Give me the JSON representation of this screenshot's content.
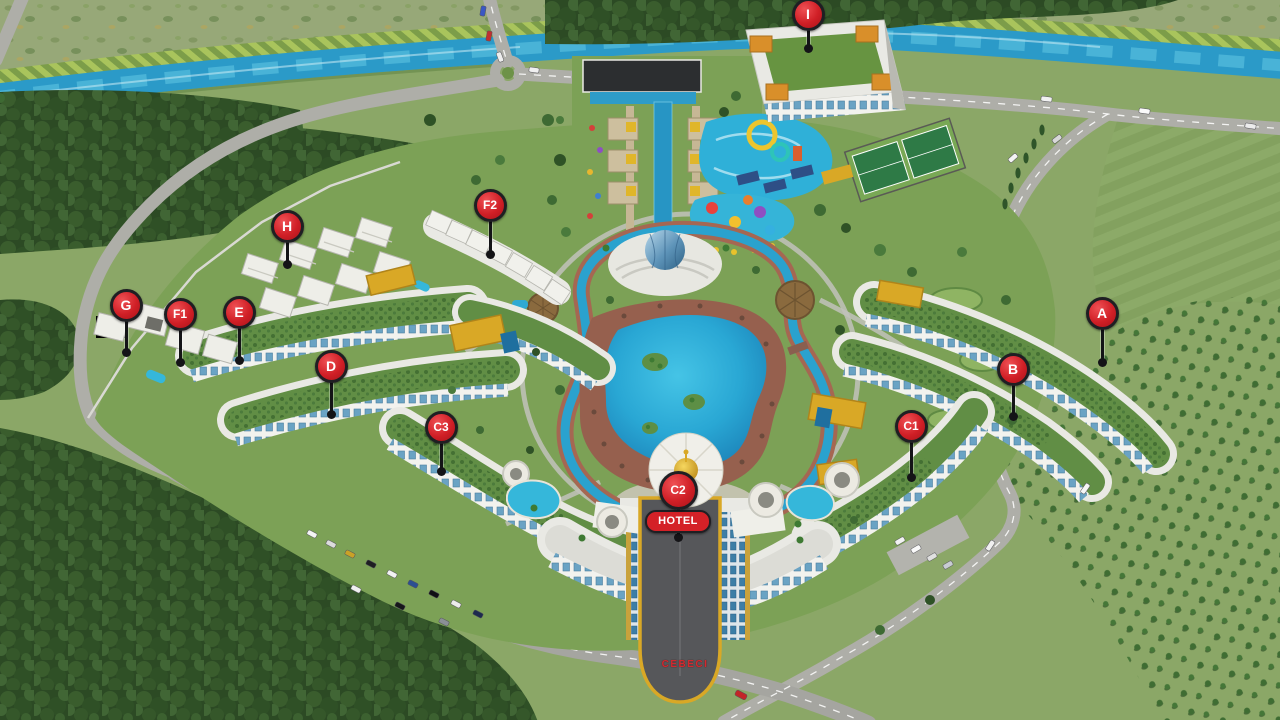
{
  "scene": {
    "type": "aerial-3d-masterplan-rendering",
    "description": "Aerial 3D rendering of a resort residential complex with labeled building pins, central lagoon pool, aquapark, amphitheatre, hotel tower, river, forests and roads",
    "entrance_sign": "CEBECI"
  },
  "markers": [
    {
      "label": "A",
      "x": 1102,
      "y": 313,
      "stem": 49
    },
    {
      "label": "B",
      "x": 1013,
      "y": 369,
      "stem": 47
    },
    {
      "label": "C1",
      "x": 911,
      "y": 426,
      "stem": 51
    },
    {
      "label": "C2",
      "x": 678,
      "y": 490,
      "stem": 47,
      "size": 33,
      "badge": "HOTEL"
    },
    {
      "label": "C3",
      "x": 441,
      "y": 427,
      "stem": 44
    },
    {
      "label": "D",
      "x": 331,
      "y": 366,
      "stem": 48
    },
    {
      "label": "E",
      "x": 239,
      "y": 312,
      "stem": 48
    },
    {
      "label": "F1",
      "x": 180,
      "y": 314,
      "stem": 48
    },
    {
      "label": "F2",
      "x": 490,
      "y": 205,
      "stem": 49
    },
    {
      "label": "G",
      "x": 126,
      "y": 305,
      "stem": 47
    },
    {
      "label": "H",
      "x": 287,
      "y": 226,
      "stem": 38
    },
    {
      "label": "I",
      "x": 808,
      "y": 14,
      "stem": 34
    }
  ],
  "colors": {
    "marker_red": "#D01F26",
    "pin_outline": "#1F1F23",
    "badge_red": "#D42127",
    "gold_accent": "#D9A826",
    "river_blue": "#2B9AC8",
    "pool_blue": "#2FB3DC",
    "lagoon_blue": "#219FD0",
    "roof_green": "#618E45",
    "field_green": "#8BA767",
    "forest_green": "#33532B",
    "road_gray": "#AEAEA8",
    "building_white": "#E9E9E4",
    "window_blue": "#6AA3C4",
    "sign_red": "#D3282E"
  }
}
